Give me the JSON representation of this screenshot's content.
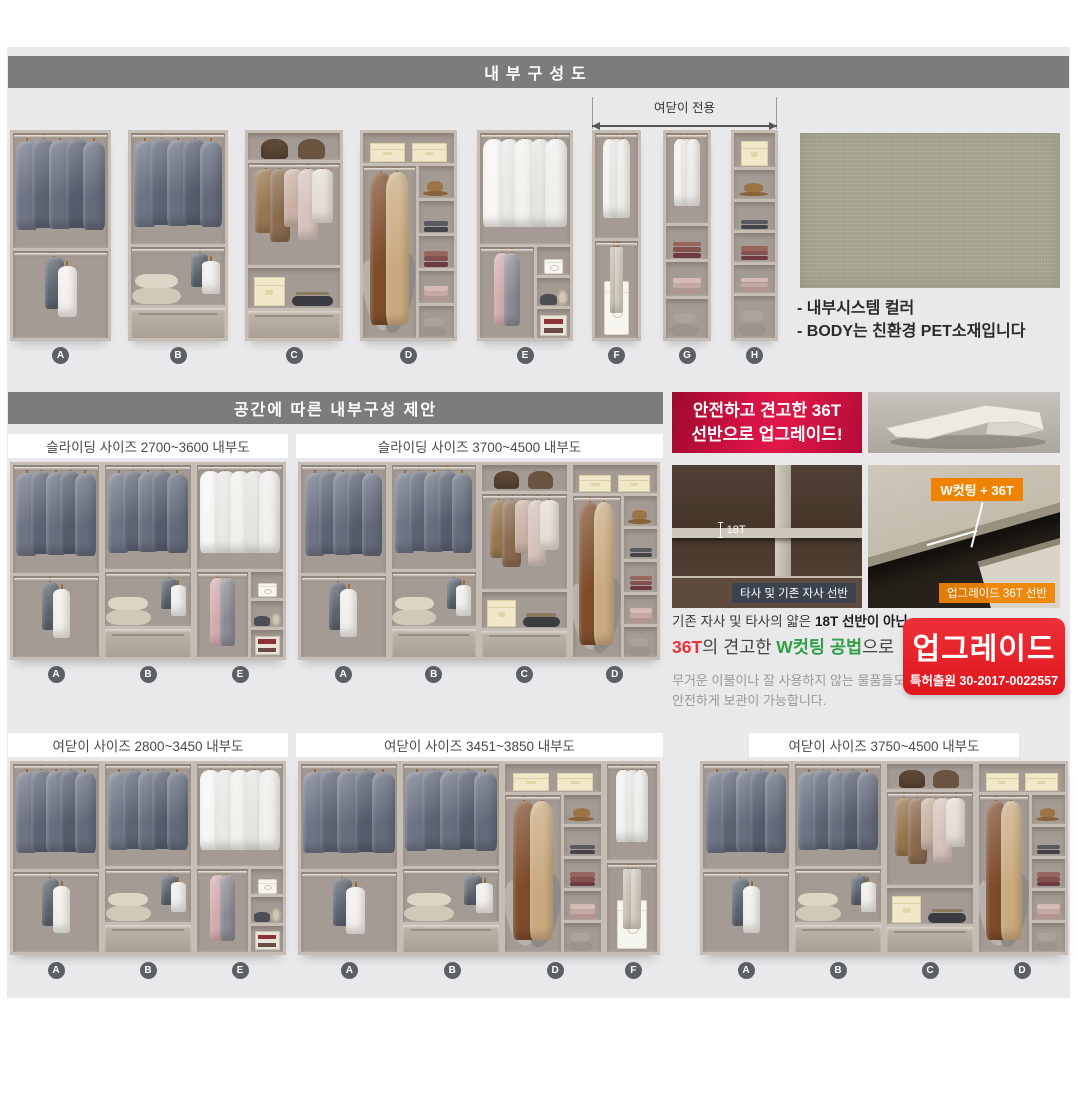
{
  "header": {
    "title": "내부구성도"
  },
  "top_row": {
    "arrow_label": "여닫이 전용",
    "ids": [
      "A",
      "B",
      "C",
      "D",
      "E",
      "F",
      "G",
      "H"
    ],
    "notes": [
      "- 내부시스템 컬러",
      "- BODY는 친환경 PET소재입니다"
    ]
  },
  "suggestion": {
    "title": "공간에 따른 내부구성 제안",
    "boxes": [
      {
        "title": "슬라이딩 사이즈 2700~3600 내부도",
        "units": [
          "A",
          "B",
          "E"
        ]
      },
      {
        "title": "슬라이딩 사이즈 3700~4500 내부도",
        "units": [
          "A",
          "B",
          "C",
          "D"
        ]
      },
      {
        "title": "여닫이 사이즈 2800~3450 내부도",
        "units": [
          "A",
          "B",
          "E"
        ]
      },
      {
        "title": "여닫이 사이즈 3451~3850 내부도",
        "units": [
          "A",
          "B",
          "D",
          "F"
        ]
      },
      {
        "title": "여닫이 사이즈 3750~4500 내부도",
        "units": [
          "A",
          "B",
          "C",
          "D"
        ]
      }
    ]
  },
  "upgrade": {
    "badge_line1": "안전하고 견고한 36T",
    "badge_line2": "선반으로 업그레이드!",
    "compare_left_measure": "18T",
    "compare_left_caption": "타사 및 기존 자사 선반",
    "compare_right_badge": "W컷팅 + 36T",
    "compare_right_caption": "업그레이드 36T 선반",
    "desc1_normal": "기존 자사 및 타사의 얇은 ",
    "desc1_bold": "18T 선반이 아닌",
    "desc2_red": "36T",
    "desc2_mid": "의 견고한 ",
    "desc2_green": "W컷팅 공법",
    "desc2_tail": "으로",
    "desc_sub1": "무거운 이불이나 잘 사용하지 않는 물품들도",
    "desc_sub2": "안전하게 보관이 가능합니다.",
    "stamp_title": "업그레이드",
    "stamp_patent": "특허출원 30-2017-0022557"
  },
  "colors": {
    "header_bar": "#7e7b7c",
    "panel_bg": "#e9e9eb",
    "badge_red": "#c50d3a",
    "stamp_red": "#e8232a",
    "accent_orange": "#ef8300",
    "accent_green": "#2f9e44",
    "accent_red_text": "#e8333a",
    "swatch": "#a8a593",
    "label_circle": "#5b6065"
  },
  "wardrobe_units": {
    "A": {
      "rows": [
        {
          "k": "hang",
          "s": "suits",
          "f": 57
        },
        {
          "k": "hang",
          "s": "few",
          "f": 43
        }
      ]
    },
    "B": {
      "rows": [
        {
          "k": "hangfloor",
          "s": "suits",
          "f": 56
        },
        {
          "k": "hangfloor",
          "s": "few",
          "floor": "hatboxes",
          "align": "right",
          "f": 29
        },
        {
          "k": "drawer",
          "f": 15
        }
      ]
    },
    "C": {
      "rows": [
        {
          "k": "cell",
          "s": "bags2",
          "f": 14
        },
        {
          "k": "hang",
          "s": "mixed",
          "f": 52
        },
        {
          "k": "cell",
          "s": "boxbelt",
          "f": 20
        },
        {
          "k": "drawer",
          "f": 14
        }
      ]
    },
    "D": {
      "rows": [
        {
          "k": "cell",
          "s": "boxes2",
          "f": 15
        },
        {
          "k": "split",
          "f": 85,
          "cols": [
            {
              "w": 60,
              "rows": [
                {
                  "k": "hangfloor",
                  "s": "coats",
                  "floor": "pillows",
                  "f": 100
                }
              ]
            },
            {
              "w": 40,
              "rows": [
                {
                  "k": "cell",
                  "s": "hat",
                  "f": 20
                },
                {
                  "k": "cell",
                  "s": "stackdark",
                  "f": 20
                },
                {
                  "k": "cell",
                  "s": "stackmaroon",
                  "f": 20
                },
                {
                  "k": "cell",
                  "s": "stackpink",
                  "f": 20
                },
                {
                  "k": "cell",
                  "s": "roundboxes",
                  "f": 20
                }
              ]
            }
          ]
        }
      ]
    },
    "E": {
      "rows": [
        {
          "k": "hang",
          "s": "shirts",
          "f": 55
        },
        {
          "k": "split",
          "f": 45,
          "cols": [
            {
              "w": 62,
              "rows": [
                {
                  "k": "hang",
                  "s": "pinkmix",
                  "f": 100
                }
              ]
            },
            {
              "w": 38,
              "rows": [
                {
                  "k": "cell",
                  "s": "whitebox",
                  "f": 33
                },
                {
                  "k": "cell",
                  "s": "darkpile",
                  "f": 33
                },
                {
                  "k": "cell",
                  "s": "sign",
                  "f": 34
                }
              ]
            }
          ]
        }
      ]
    },
    "F": {
      "rows": [
        {
          "k": "hang",
          "s": "shirts3",
          "f": 52
        },
        {
          "k": "hangfloor",
          "s": "pants",
          "floor": "whitebox",
          "f": 48
        }
      ]
    },
    "G": {
      "rows": [
        {
          "k": "hang",
          "s": "shirts3",
          "f": 46
        },
        {
          "k": "cell",
          "s": "stackmaroon",
          "f": 17
        },
        {
          "k": "cell",
          "s": "stackpink",
          "f": 17
        },
        {
          "k": "cell",
          "s": "roundboxes",
          "f": 20
        }
      ]
    },
    "H": {
      "rows": [
        {
          "k": "cell",
          "s": "box1",
          "f": 18
        },
        {
          "k": "cell",
          "s": "hat",
          "f": 15
        },
        {
          "k": "cell",
          "s": "stackdark",
          "f": 15
        },
        {
          "k": "cell",
          "s": "stackmaroon",
          "f": 15
        },
        {
          "k": "cell",
          "s": "stackpink",
          "f": 15
        },
        {
          "k": "cell",
          "s": "roundboxes",
          "f": 22
        }
      ]
    }
  }
}
